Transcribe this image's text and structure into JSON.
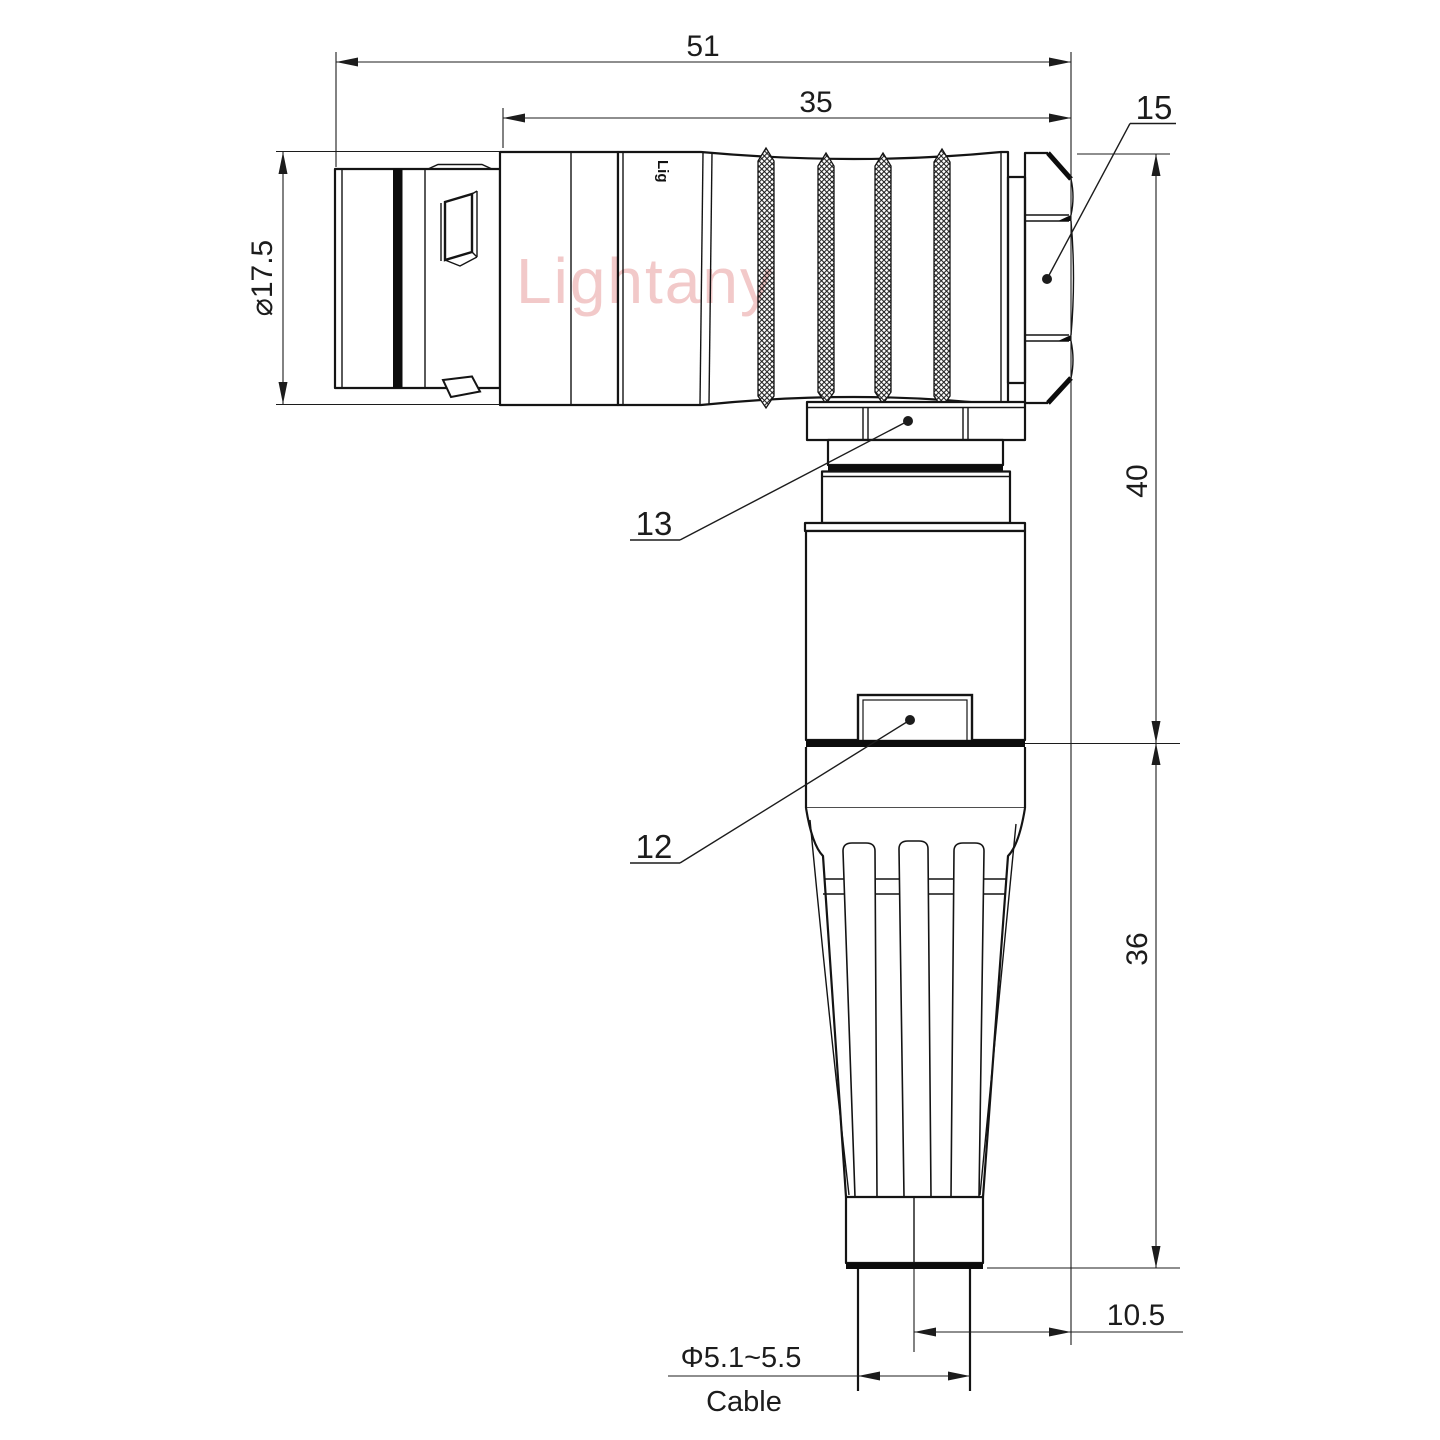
{
  "watermark": "Lightany",
  "engraving": "Lig",
  "dimensions": {
    "overall_length": "51",
    "rear_length": "35",
    "shell_diameter": "⌀17.5",
    "elbow_height": "40",
    "boot_height": "36",
    "cable_offset": "10.5",
    "cable_diameter": "Φ5.1~5.5",
    "cable_label": "Cable"
  },
  "part_labels": {
    "hex_nut": "15",
    "coupling_ring": "13",
    "latch": "12"
  }
}
